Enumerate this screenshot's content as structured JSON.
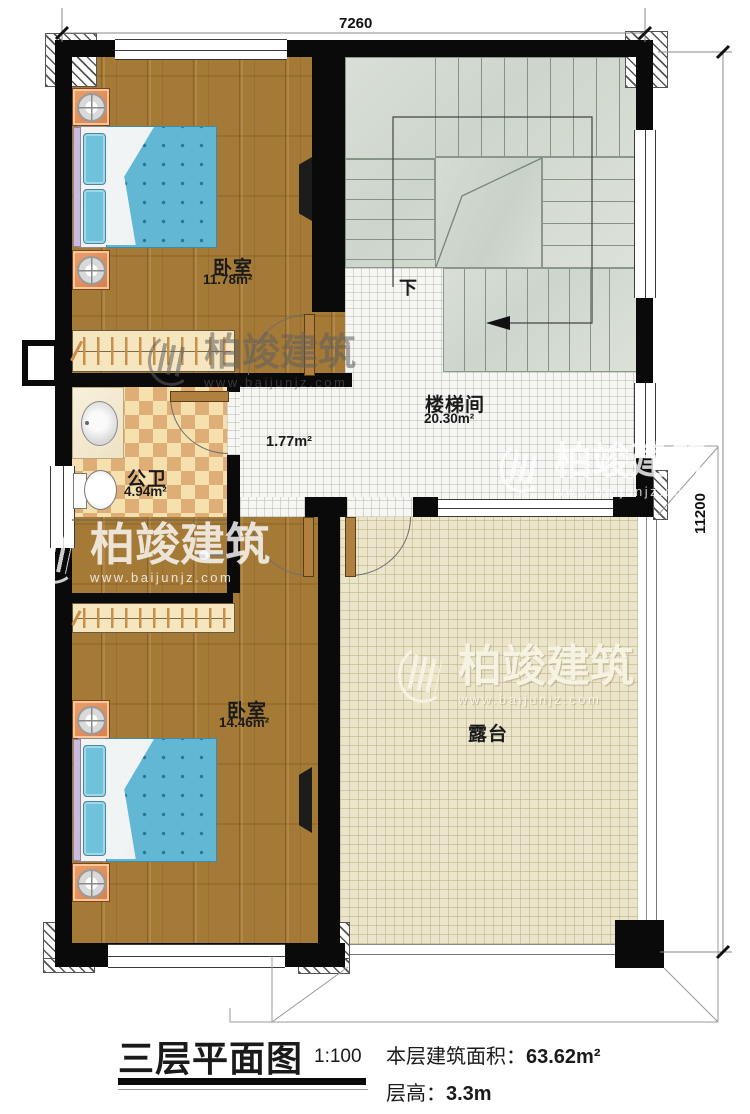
{
  "colors": {
    "wall": "#0a0a0a",
    "wood_floor": "#a1752f",
    "mattress_blue": "#62b8d4",
    "bathroom_tile": "#dfae76",
    "stair_sage": "#d6dcd2",
    "terrace_beige": "#ebe5cc",
    "nightstand_orange": "#dd8757"
  },
  "dimensions": {
    "top": "7260",
    "right": "11200"
  },
  "rooms": {
    "bedroom_top": {
      "name": "卧室",
      "area": "11.78m²"
    },
    "bedroom_bottom": {
      "name": "卧室",
      "area": "14.46m²"
    },
    "bathroom": {
      "name": "公卫",
      "area": "4.94m²"
    },
    "stairwell": {
      "name": "楼梯间",
      "area": "20.30m²"
    },
    "hallway": {
      "area": "1.77m²"
    },
    "terrace": {
      "name": "露台"
    }
  },
  "stairs": {
    "down_label": "下"
  },
  "watermark": {
    "brand": "柏竣建筑",
    "url": "www.baijunjz.com"
  },
  "title_block": {
    "title": "三层平面图",
    "scale": "1:100",
    "area_label": "本层建筑面积：",
    "area_value": "63.62m²",
    "floor_height_label": "层高：",
    "floor_height_value": "3.3m"
  }
}
